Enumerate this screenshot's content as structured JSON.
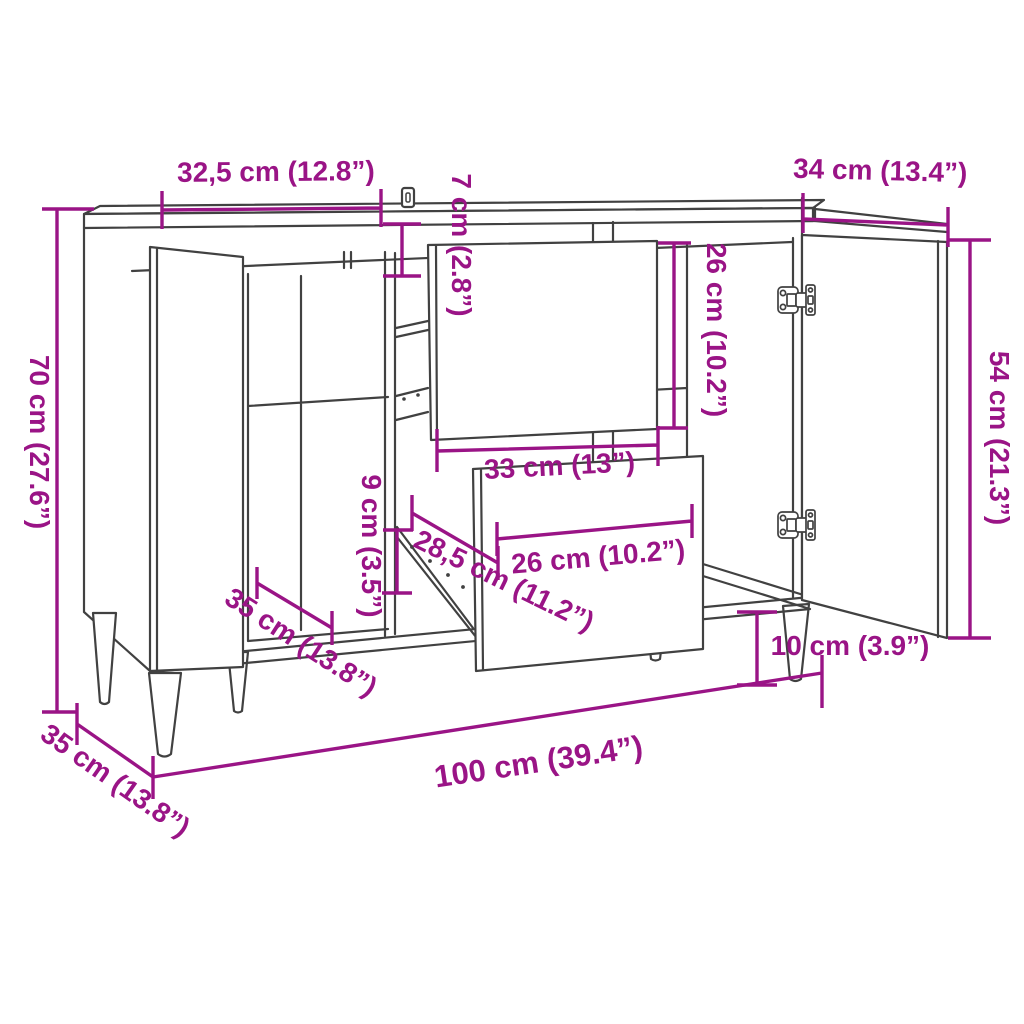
{
  "diagram": {
    "type": "furniture-dimension-drawing",
    "subject": "sideboard with two open doors, two pulled-out drawers and tapered legs",
    "units": {
      "primary": "cm",
      "secondary": "inches"
    }
  },
  "colors": {
    "dimension_color": "#9a1486",
    "line_color": "#414141",
    "background": "#ffffff"
  },
  "dimensions": {
    "left_door_width": "32,5 cm (12.8”)",
    "right_door_width": "34 cm (13.4”)",
    "top_clearance": "7 cm (2.8”)",
    "drawer_front_height": "26 cm (10.2”)",
    "overall_height": "70 cm (27.6”)",
    "door_height": "54 cm (21.3”)",
    "drawer_side_height": "9 cm (3.5”)",
    "drawer_front_width": "33 cm (13”)",
    "drawer_depth": "28,5 cm (11.2”)",
    "drawer_inner_width": "26 cm (10.2”)",
    "shelf_depth": "35 cm (13.8”)",
    "overall_depth": "35 cm (13.8”)",
    "overall_width": "100 cm (39.4”)",
    "leg_height": "10 cm (3.9”)"
  }
}
